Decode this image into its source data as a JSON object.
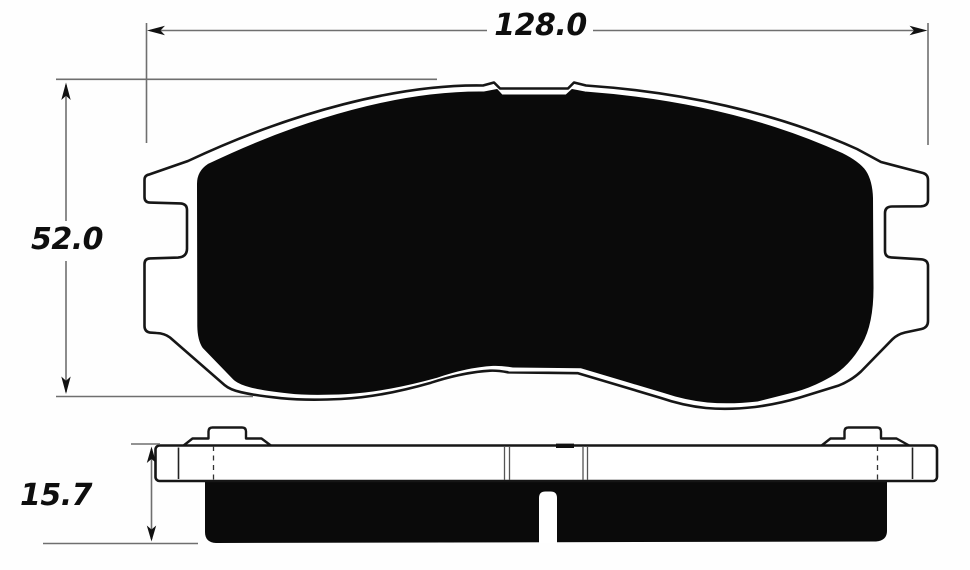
{
  "drawing": {
    "dims": {
      "width": "128.0",
      "height": "52.0",
      "thickness": "15.7"
    },
    "colors": {
      "background": "#ffffff",
      "ink": "#141414",
      "friction_fill": "#0a0a0a",
      "dimension_lines": "#6f6f6f",
      "text": "#0e0e0e"
    }
  }
}
